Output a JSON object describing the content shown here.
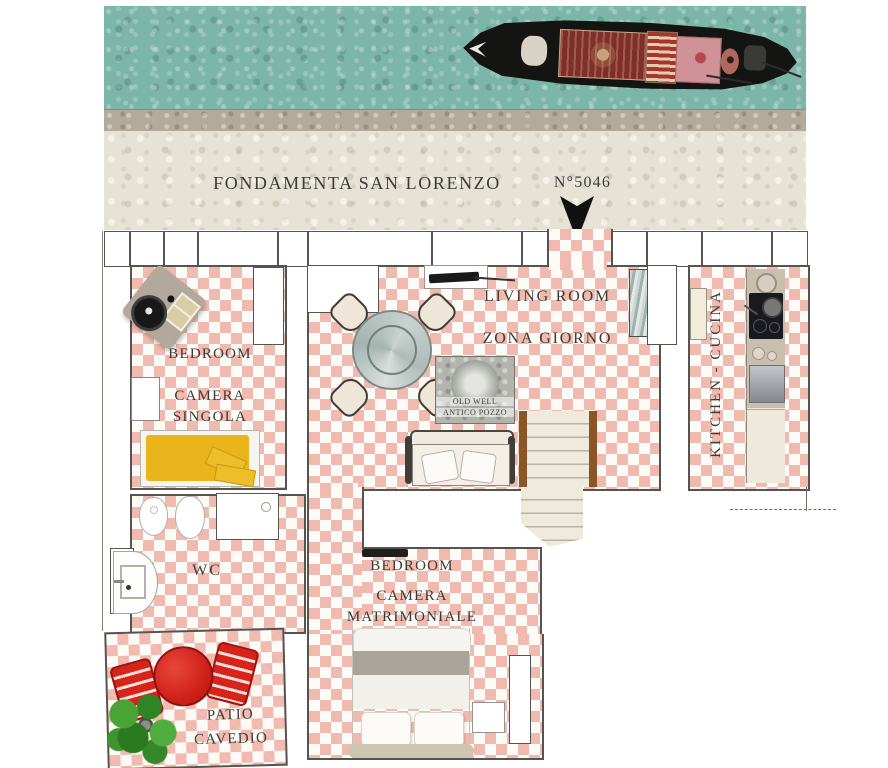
{
  "street": {
    "name": "FONDAMENTA SAN LORENZO",
    "house_number": "N°5046"
  },
  "rooms": {
    "living_room": {
      "title": "LIVING ROOM",
      "subtitle": "ZONA GIORNO"
    },
    "bedroom_single": {
      "title": "BEDROOM",
      "subtitle1": "CAMERA",
      "subtitle2": "SINGOLA"
    },
    "bedroom_double": {
      "title": "BEDROOM",
      "subtitle1": "CAMERA",
      "subtitle2": "MATRIMONIALE"
    },
    "kitchen": {
      "title": "KITCHEN - CUCINA"
    },
    "wc": {
      "title": "WC"
    },
    "patio": {
      "title": "PATIO",
      "subtitle": "CAVEDIO"
    },
    "old_well": {
      "title": "OLD WELL",
      "subtitle": "ANTICO POZZO"
    }
  },
  "colors": {
    "water": "#7cb6a8",
    "stone": "#b3aa9b",
    "pavement": "#e6e2d5",
    "floor_pink": "#f1bab0",
    "floor_white": "#fdfbf6",
    "wall_line": "#56544e",
    "patio_red": "#d8231b",
    "bed_yellow": "#e9b41c",
    "stair_wood": "#8a5527",
    "text": "#3b3b38"
  }
}
